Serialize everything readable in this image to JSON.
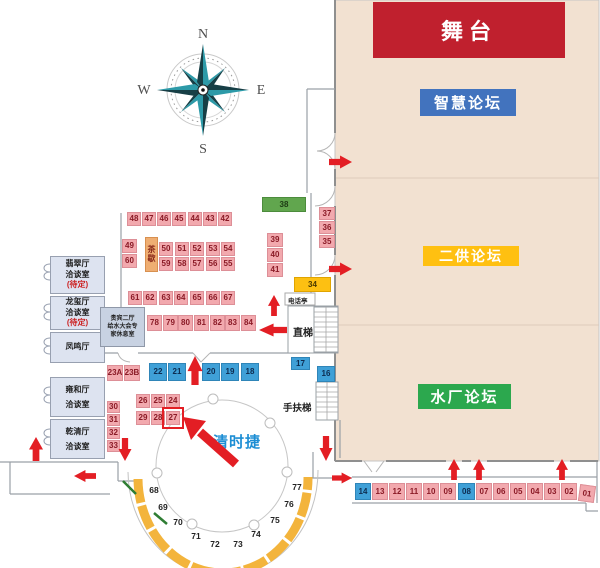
{
  "colors": {
    "hall": "#f2e1d1",
    "stage": "#c0202e",
    "forum_blue": "#4273be",
    "forum_yellow": "#ffc011",
    "forum_green": "#2ca84e",
    "arrow": "#e31e24",
    "wall": "#9aa0a6",
    "callout_text": "#1d8ed4",
    "compass_teal": "#2d9aa8",
    "compass_dark": "#173f46",
    "booth": {
      "p": {
        "bg": "#f2a9ae",
        "bd": "#dd8f97",
        "fg": "#8a1a26"
      },
      "b": {
        "bg": "#3fa0d7",
        "bd": "#2f85b8",
        "fg": "#0d2c50"
      },
      "y": {
        "bg": "#fdc012",
        "bd": "#e0a400",
        "fg": "#4a3a00"
      },
      "g": {
        "bg": "#61a64e",
        "bd": "#4c8c3c",
        "fg": "#1d3a14"
      },
      "t": {
        "bg": "#efae72",
        "bd": "#d89050",
        "fg": "#8a2a1a"
      }
    }
  },
  "compass": {
    "n": "N",
    "e": "E",
    "s": "S",
    "w": "W"
  },
  "stage": {
    "label": "舞台"
  },
  "forums": [
    {
      "label": "智慧论坛"
    },
    {
      "label": "二供论坛"
    },
    {
      "label": "水厂论坛"
    }
  ],
  "rooms": [
    {
      "name": "翡翠厅\n洽谈室",
      "note": "(待定)"
    },
    {
      "name": "龙玺厅\n洽谈室",
      "note": "(待定)"
    },
    {
      "name": "凤鸣厅",
      "note": ""
    },
    {
      "name": "雍和厅\n洽谈室",
      "note": ""
    },
    {
      "name": "乾清厅\n洽谈室",
      "note": ""
    }
  ],
  "vip_room": {
    "label": "贵宾二厅\n给水大会专\n家休息室"
  },
  "facilities": {
    "elevator": "直梯",
    "escalator": "手扶梯",
    "phone": "电话亭",
    "tea": "茶\n歇"
  },
  "callout": {
    "label": "清时捷",
    "target_booth": "27"
  },
  "booths": [
    {
      "n": "48",
      "x": 127,
      "y": 212,
      "w": 14,
      "h": 14,
      "c": "p"
    },
    {
      "n": "47",
      "x": 142,
      "y": 212,
      "w": 14,
      "h": 14,
      "c": "p"
    },
    {
      "n": "46",
      "x": 157,
      "y": 212,
      "w": 14,
      "h": 14,
      "c": "p"
    },
    {
      "n": "45",
      "x": 172,
      "y": 212,
      "w": 14,
      "h": 14,
      "c": "p"
    },
    {
      "n": "44",
      "x": 188,
      "y": 212,
      "w": 14,
      "h": 14,
      "c": "p"
    },
    {
      "n": "43",
      "x": 203,
      "y": 212,
      "w": 14,
      "h": 14,
      "c": "p"
    },
    {
      "n": "42",
      "x": 218,
      "y": 212,
      "w": 14,
      "h": 14,
      "c": "p"
    },
    {
      "n": "49",
      "x": 122,
      "y": 239,
      "w": 15,
      "h": 14,
      "c": "p"
    },
    {
      "n": "60",
      "x": 122,
      "y": 254,
      "w": 15,
      "h": 14,
      "c": "p"
    },
    {
      "n": "50",
      "x": 159,
      "y": 242,
      "w": 14,
      "h": 14,
      "c": "p"
    },
    {
      "n": "51",
      "x": 175,
      "y": 242,
      "w": 14,
      "h": 14,
      "c": "p"
    },
    {
      "n": "52",
      "x": 190,
      "y": 242,
      "w": 14,
      "h": 14,
      "c": "p"
    },
    {
      "n": "53",
      "x": 206,
      "y": 242,
      "w": 14,
      "h": 14,
      "c": "p"
    },
    {
      "n": "54",
      "x": 221,
      "y": 242,
      "w": 14,
      "h": 14,
      "c": "p"
    },
    {
      "n": "59",
      "x": 159,
      "y": 257,
      "w": 14,
      "h": 14,
      "c": "p"
    },
    {
      "n": "58",
      "x": 175,
      "y": 257,
      "w": 14,
      "h": 14,
      "c": "p"
    },
    {
      "n": "57",
      "x": 190,
      "y": 257,
      "w": 14,
      "h": 14,
      "c": "p"
    },
    {
      "n": "56",
      "x": 206,
      "y": 257,
      "w": 14,
      "h": 14,
      "c": "p"
    },
    {
      "n": "55",
      "x": 221,
      "y": 257,
      "w": 14,
      "h": 14,
      "c": "p"
    },
    {
      "n": "61",
      "x": 128,
      "y": 291,
      "w": 14,
      "h": 14,
      "c": "p"
    },
    {
      "n": "62",
      "x": 143,
      "y": 291,
      "w": 14,
      "h": 14,
      "c": "p"
    },
    {
      "n": "63",
      "x": 159,
      "y": 291,
      "w": 14,
      "h": 14,
      "c": "p"
    },
    {
      "n": "64",
      "x": 174,
      "y": 291,
      "w": 14,
      "h": 14,
      "c": "p"
    },
    {
      "n": "65",
      "x": 190,
      "y": 291,
      "w": 14,
      "h": 14,
      "c": "p"
    },
    {
      "n": "66",
      "x": 206,
      "y": 291,
      "w": 14,
      "h": 14,
      "c": "p"
    },
    {
      "n": "67",
      "x": 221,
      "y": 291,
      "w": 14,
      "h": 14,
      "c": "p"
    },
    {
      "n": "78",
      "x": 147,
      "y": 315,
      "w": 15,
      "h": 16,
      "c": "p"
    },
    {
      "n": "79",
      "x": 163,
      "y": 315,
      "w": 15,
      "h": 16,
      "c": "p"
    },
    {
      "n": "80",
      "x": 178,
      "y": 315,
      "w": 15,
      "h": 16,
      "c": "p"
    },
    {
      "n": "81",
      "x": 194,
      "y": 315,
      "w": 15,
      "h": 16,
      "c": "p"
    },
    {
      "n": "82",
      "x": 210,
      "y": 315,
      "w": 15,
      "h": 16,
      "c": "p"
    },
    {
      "n": "83",
      "x": 225,
      "y": 315,
      "w": 15,
      "h": 16,
      "c": "p"
    },
    {
      "n": "84",
      "x": 241,
      "y": 315,
      "w": 15,
      "h": 16,
      "c": "p"
    },
    {
      "n": "38",
      "x": 262,
      "y": 197,
      "w": 44,
      "h": 15,
      "c": "g"
    },
    {
      "n": "39",
      "x": 267,
      "y": 233,
      "w": 16,
      "h": 14,
      "c": "p"
    },
    {
      "n": "40",
      "x": 267,
      "y": 248,
      "w": 16,
      "h": 14,
      "c": "p"
    },
    {
      "n": "41",
      "x": 267,
      "y": 263,
      "w": 16,
      "h": 14,
      "c": "p"
    },
    {
      "n": "37",
      "x": 319,
      "y": 207,
      "w": 16,
      "h": 13,
      "c": "p"
    },
    {
      "n": "36",
      "x": 319,
      "y": 221,
      "w": 16,
      "h": 13,
      "c": "p"
    },
    {
      "n": "35",
      "x": 319,
      "y": 235,
      "w": 16,
      "h": 13,
      "c": "p"
    },
    {
      "n": "34",
      "x": 294,
      "y": 277,
      "w": 37,
      "h": 15,
      "c": "y"
    },
    {
      "n": "23A",
      "x": 107,
      "y": 365,
      "w": 16,
      "h": 16,
      "c": "p"
    },
    {
      "n": "23B",
      "x": 124,
      "y": 365,
      "w": 16,
      "h": 16,
      "c": "p"
    },
    {
      "n": "22",
      "x": 149,
      "y": 363,
      "w": 18,
      "h": 18,
      "c": "b"
    },
    {
      "n": "21",
      "x": 168,
      "y": 363,
      "w": 18,
      "h": 18,
      "c": "b"
    },
    {
      "n": "20",
      "x": 202,
      "y": 363,
      "w": 18,
      "h": 18,
      "c": "b"
    },
    {
      "n": "19",
      "x": 221,
      "y": 363,
      "w": 18,
      "h": 18,
      "c": "b"
    },
    {
      "n": "18",
      "x": 241,
      "y": 363,
      "w": 18,
      "h": 18,
      "c": "b"
    },
    {
      "n": "17",
      "x": 291,
      "y": 357,
      "w": 19,
      "h": 13,
      "c": "b"
    },
    {
      "n": "16",
      "x": 317,
      "y": 366,
      "w": 18,
      "h": 16,
      "c": "b"
    },
    {
      "n": "26",
      "x": 136,
      "y": 394,
      "w": 14,
      "h": 14,
      "c": "p"
    },
    {
      "n": "25",
      "x": 151,
      "y": 394,
      "w": 14,
      "h": 14,
      "c": "p"
    },
    {
      "n": "24",
      "x": 166,
      "y": 394,
      "w": 14,
      "h": 14,
      "c": "p"
    },
    {
      "n": "29",
      "x": 136,
      "y": 411,
      "w": 14,
      "h": 14,
      "c": "p"
    },
    {
      "n": "28",
      "x": 151,
      "y": 411,
      "w": 14,
      "h": 14,
      "c": "p"
    },
    {
      "n": "27",
      "x": 166,
      "y": 411,
      "w": 14,
      "h": 14,
      "c": "p"
    },
    {
      "n": "30",
      "x": 107,
      "y": 401,
      "w": 13,
      "h": 12,
      "c": "p"
    },
    {
      "n": "31",
      "x": 107,
      "y": 414,
      "w": 13,
      "h": 12,
      "c": "p"
    },
    {
      "n": "32",
      "x": 107,
      "y": 427,
      "w": 13,
      "h": 12,
      "c": "p"
    },
    {
      "n": "33",
      "x": 107,
      "y": 440,
      "w": 13,
      "h": 12,
      "c": "p"
    },
    {
      "n": "14",
      "x": 355,
      "y": 483,
      "w": 16,
      "h": 17,
      "c": "b"
    },
    {
      "n": "13",
      "x": 372,
      "y": 483,
      "w": 16,
      "h": 17,
      "c": "p"
    },
    {
      "n": "12",
      "x": 389,
      "y": 483,
      "w": 16,
      "h": 17,
      "c": "p"
    },
    {
      "n": "11",
      "x": 406,
      "y": 483,
      "w": 16,
      "h": 17,
      "c": "p"
    },
    {
      "n": "10",
      "x": 423,
      "y": 483,
      "w": 16,
      "h": 17,
      "c": "p"
    },
    {
      "n": "09",
      "x": 440,
      "y": 483,
      "w": 16,
      "h": 17,
      "c": "p"
    },
    {
      "n": "08",
      "x": 458,
      "y": 483,
      "w": 17,
      "h": 17,
      "c": "b"
    },
    {
      "n": "07",
      "x": 476,
      "y": 483,
      "w": 16,
      "h": 17,
      "c": "p"
    },
    {
      "n": "06",
      "x": 493,
      "y": 483,
      "w": 16,
      "h": 17,
      "c": "p"
    },
    {
      "n": "05",
      "x": 510,
      "y": 483,
      "w": 16,
      "h": 17,
      "c": "p"
    },
    {
      "n": "04",
      "x": 527,
      "y": 483,
      "w": 16,
      "h": 17,
      "c": "p"
    },
    {
      "n": "03",
      "x": 544,
      "y": 483,
      "w": 16,
      "h": 17,
      "c": "p"
    },
    {
      "n": "02",
      "x": 561,
      "y": 483,
      "w": 16,
      "h": 17,
      "c": "p"
    },
    {
      "n": "01",
      "x": 579,
      "y": 485,
      "w": 16,
      "h": 17,
      "c": "p",
      "r": 8
    }
  ],
  "curve_booths": [
    {
      "n": "68",
      "x": 154,
      "y": 490
    },
    {
      "n": "69",
      "x": 163,
      "y": 507
    },
    {
      "n": "70",
      "x": 178,
      "y": 522
    },
    {
      "n": "71",
      "x": 196,
      "y": 536
    },
    {
      "n": "72",
      "x": 215,
      "y": 544
    },
    {
      "n": "73",
      "x": 238,
      "y": 544
    },
    {
      "n": "74",
      "x": 256,
      "y": 534
    },
    {
      "n": "75",
      "x": 275,
      "y": 520
    },
    {
      "n": "76",
      "x": 289,
      "y": 504
    },
    {
      "n": "77",
      "x": 297,
      "y": 487
    }
  ],
  "arrows": [
    {
      "d": "up",
      "x": 36,
      "y": 437,
      "l": 24,
      "w": 14
    },
    {
      "d": "left",
      "x": 74,
      "y": 476,
      "l": 22,
      "w": 12
    },
    {
      "d": "down",
      "x": 125,
      "y": 461,
      "l": 23,
      "w": 13
    },
    {
      "d": "up",
      "x": 195,
      "y": 356,
      "l": 29,
      "w": 15
    },
    {
      "d": "up",
      "x": 274,
      "y": 295,
      "l": 21,
      "w": 12
    },
    {
      "d": "left",
      "x": 259,
      "y": 330,
      "l": 28,
      "w": 13
    },
    {
      "d": "right",
      "x": 352,
      "y": 162,
      "l": 23,
      "w": 13
    },
    {
      "d": "right",
      "x": 352,
      "y": 269,
      "l": 23,
      "w": 13
    },
    {
      "d": "down",
      "x": 326,
      "y": 461,
      "l": 25,
      "w": 13
    },
    {
      "d": "right",
      "x": 352,
      "y": 478,
      "l": 20,
      "w": 11
    },
    {
      "d": "up",
      "x": 454,
      "y": 459,
      "l": 21,
      "w": 12
    },
    {
      "d": "up",
      "x": 479,
      "y": 459,
      "l": 21,
      "w": 12
    },
    {
      "d": "up",
      "x": 562,
      "y": 459,
      "l": 21,
      "w": 12
    }
  ]
}
